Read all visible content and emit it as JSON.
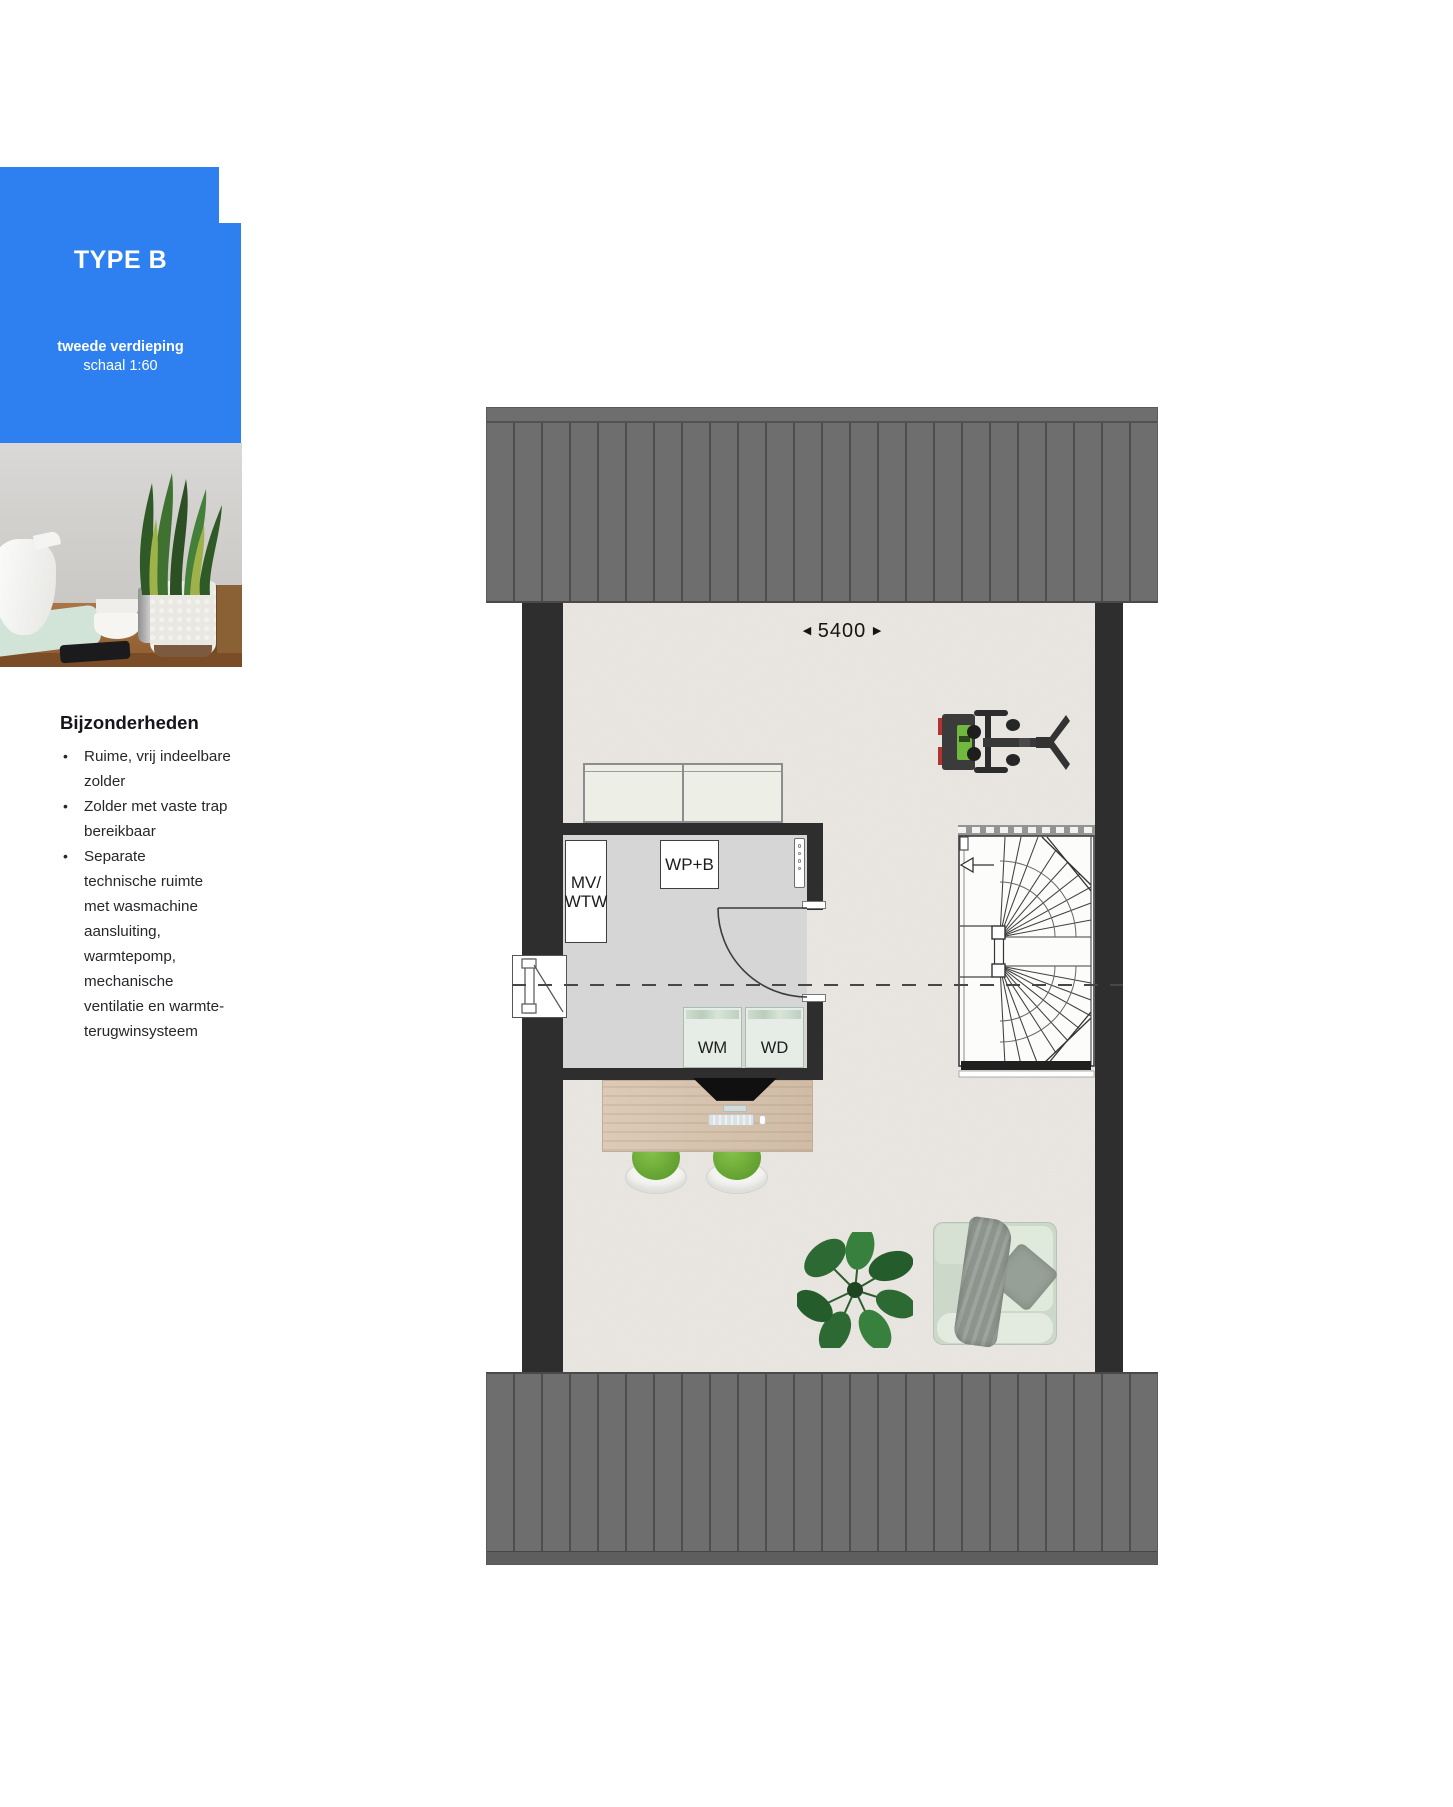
{
  "sidebar": {
    "type_label": "TYPE B",
    "floor_label": "tweede verdieping",
    "scale_label": "schaal 1:60",
    "details_heading": "Bijzonderheden",
    "bullets": [
      "Ruime, vrij indeelbare\nzolder",
      "Zolder met vaste trap\nbereikbaar",
      "Separate\ntechnische ruimte\nmet wasmachine\naansluiting,\nwarmtepomp,\nmechanische\nventilatie en warmte-\nterugwinsysteem"
    ]
  },
  "plan": {
    "dimension_value": "5400",
    "dimension_arrow_left": "◀",
    "dimension_arrow_right": "▶",
    "room_labels": {
      "ventilation_unit": "MV/\nWTW",
      "heat_pump": "WP+B",
      "washing_machine": "WM",
      "dryer": "WD"
    }
  },
  "colors": {
    "accent_blue": "#2e80f1",
    "roof_gray": "#6e6e6e",
    "wall_dark": "#2e2e2e",
    "floor_light": "#eae7e2",
    "tech_room_floor": "#d6d6d6"
  }
}
